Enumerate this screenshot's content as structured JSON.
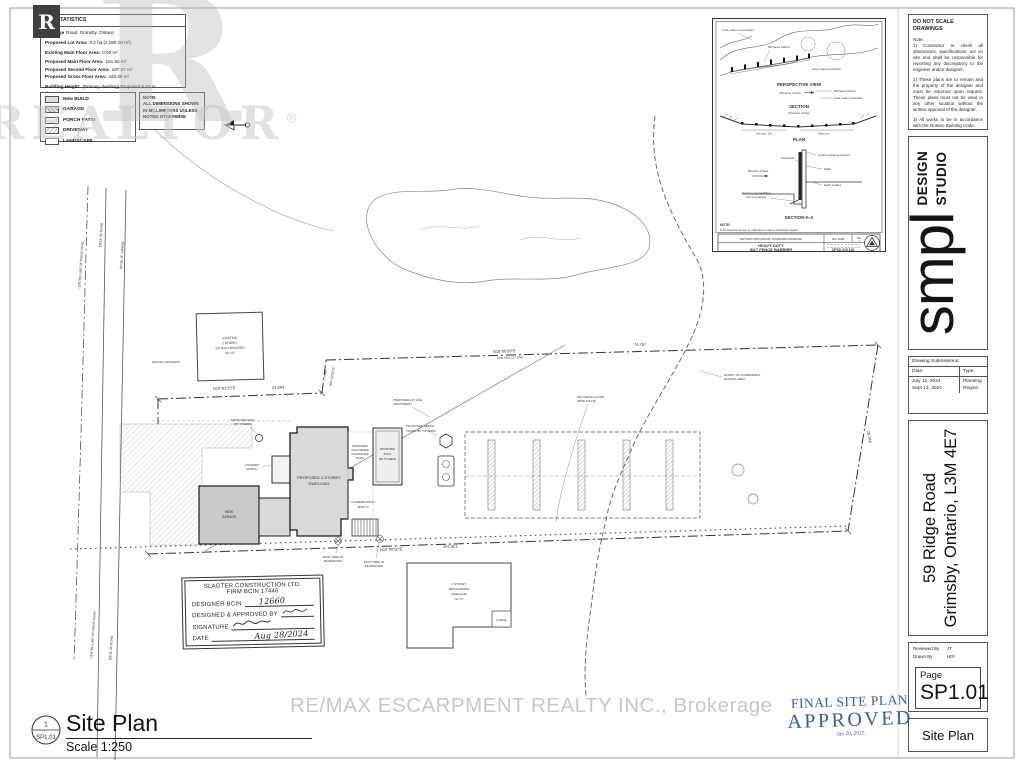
{
  "watermark": {
    "block_r": "R",
    "big_r": "R",
    "word": "REALTOR",
    "reg": "®",
    "remax": "RE/MAX ESCARPMENT REALTY INC., Brokerage"
  },
  "lot_statistics": {
    "title": "LOT STATISTICS",
    "address_bold": "59 Ridge",
    "address_rest": "Road, Grimsby, Ontario",
    "rows": [
      {
        "label": "Proposed Lot Area:",
        "value": "0.2 ha (2,086.00 m²)"
      },
      {
        "label": "Existing Main Floor Area:",
        "value": "0.00 m²"
      },
      {
        "label": "Proposed Main Floor Area:",
        "value": "161.82 m²"
      },
      {
        "label": "Proposed Second Floor Area:",
        "value": "187.47 m²"
      },
      {
        "label": "Proposed Gross Floor Area:",
        "value": "349.29 m²"
      },
      {
        "label": "Building Height:",
        "value": "(Primary dwelling) Proposed 9.03 m"
      },
      {
        "label": "",
        "value": "(from mean grade)"
      }
    ]
  },
  "legend": {
    "items": [
      {
        "label": "New BUILD"
      },
      {
        "label": "GARAGE"
      },
      {
        "label": "PORCH PATIO"
      },
      {
        "label": "DRIVEWAY"
      },
      {
        "label": "LANDSCAPE"
      }
    ],
    "note_title": "NOTE:",
    "note1": "ALL DIMENSIONS SHOWN",
    "note2": "IN MILLIMETERS UNLESS",
    "note3": "NOTED OTHERWISE"
  },
  "detail": {
    "area_construction": "Area under construction",
    "silt_barrier": "Silt fence barrier",
    "area_protection": "Area under protection",
    "flow": "Direction of flow",
    "perspective": "PERSPECTIVE VIEW",
    "section": "SECTION",
    "plan": "PLAN",
    "dim_typ": "3m max, Typ",
    "main_run": "Main run",
    "support": "Control measure support",
    "geotextile": "Geotextile",
    "stake": "Stake",
    "earth": "Earth surface",
    "trench1": "Trench to be backfilled",
    "trench2": "and compacted",
    "section_aa": "SECTION A-A",
    "note": "NOTE:",
    "note_a": "A  All dimensions are in millimetres unless otherwise shown.",
    "footer_left": "ONTARIO PROVINCIAL STANDARD DRAWING",
    "footer_date": "Nov 2006",
    "footer_rev": "Rev",
    "footer_rev_num": "1",
    "title1": "HEAVY-DUTY",
    "title2": "SILT FENCE BARRIER",
    "opsd": "OPSD 219.130"
  },
  "plan": {
    "labels": {
      "gravel": "GRAVEL DRIVEWAY",
      "exist1": "EXISTING",
      "exist2": "2 STOREY",
      "exist3": "STUCCO BUILDING",
      "exist4": "No. 61",
      "dim_a_bearing": "N19°01'25\"E",
      "dim_a_len": "24.994",
      "jog_len": "5.486",
      "jog_bearing": "N61°10'55\"W",
      "dim_top_bearing": "N19°00'50\"E",
      "dim_top_len": "74.767",
      "existing_lot_line": "EXISTING LOT LINE",
      "adj1": "PROPOSED LOT LINE",
      "adj2": "ADJUSTMENT",
      "silt1": "SILT FENCE (A) PER",
      "silt2": "OPSD 219.130",
      "nat1": "EXTENT OF GOVERNMENT",
      "nat2": "NATURAL AREA",
      "dwel1": "PROPOSED 2-STOREY",
      "dwel2": "DWELLING",
      "garage1": "NEW",
      "garage2": "GARAGE",
      "porch1": "COVERED",
      "porch2": "PORCH",
      "patio1": "PROPOSED",
      "patio2": "UNCOVERED",
      "patio3": "AGGREGATE",
      "patio4": "PATIO",
      "pool1": "PROPOSED",
      "pool2": "POOL",
      "pool3": "(BY OTHERS)",
      "septic1": "PROPOSED SEPTIC",
      "septic2": "TANKS (BY OTHERS)",
      "well1": "PROPOSED WELL",
      "well2": "(BY OTHERS)",
      "covpatio1": "COVERED PATIO",
      "covpatio2": "38.06 m²",
      "dim_bot_bearing": "N19°00'50\"E",
      "dim_bot_len": "102.451",
      "tree1": "EXIST. TREE TO",
      "tree2": "BE REMOVED",
      "n571": "2 STOREY",
      "n572": "BRICK/SIDING",
      "n573": "DWELLING",
      "n574": "No. 57",
      "garage57": "GARAGE",
      "dim_east": "28.346",
      "road1": "CENTRE LINE OF RIDGE ROAD",
      "road2": "EDGE OF ROAD",
      "road3": "EDGE OF GRAVEL"
    }
  },
  "signature_box": {
    "company": "SLAGTER CONSTRUCTION LTD.",
    "firm": "FIRM BCIN 17446",
    "designer_label": "DESIGNER BCIN",
    "designer_value": "12660",
    "approved_label": "DESIGNED & APPROVED BY",
    "signature_label": "SIGNATURE",
    "date_label": "DATE",
    "date_value": "Aug 28/2024"
  },
  "titleblock": {
    "do_not_scale": "DO NOT SCALE DRAWINGS",
    "note_label": "Note:",
    "note1": "1)  Contractor to check all dimensions, specifications, act on site and shall be responsible for reporting any discrepancy to the engineer and/or designer.",
    "note2": "2)  These plans are to remain and the property of the designer and must be returned upon request. These plans must not be used in any other location without the written approval of the designer.",
    "note3": "3)  All works to be in accordance with the Ontario Building Code.",
    "logo_word": "smpl",
    "logo_sub1": "DESIGN",
    "logo_sub2": "STUDIO",
    "submissions_title": "Drawing Submissions:",
    "col_date": "Date:",
    "col_type": "Type:",
    "rows": [
      {
        "date": "July 12, 2024",
        "type": "Planning"
      },
      {
        "date": "Sept 13, 2024",
        "type": "Region"
      }
    ],
    "address_line1": "59 Ridge Road",
    "address_line2": "Grimsby, Ontario, L3M 4E7",
    "reviewed_label": "Reviewed By",
    "reviewed_value": "JT",
    "drawn_label": "Drawn By",
    "drawn_value": "HD²",
    "page_label": "Page",
    "page_value": "SP1.01",
    "sheet_title": "Site Plan"
  },
  "stamp": {
    "line1": "FINAL SITE PLAN",
    "line2": "APPROVED",
    "date": "Jan 20, 2025"
  },
  "footer": {
    "ref_num": "1",
    "ref_sheet": "SP1.01",
    "title": "Site Plan",
    "scale": "Scale 1:250"
  },
  "colors": {
    "stamp_blue": "#3b58a8",
    "watermark_gray": "#c9c9c9",
    "building_fill": "#d9d9d9",
    "garage_fill": "#c9c9c9"
  }
}
